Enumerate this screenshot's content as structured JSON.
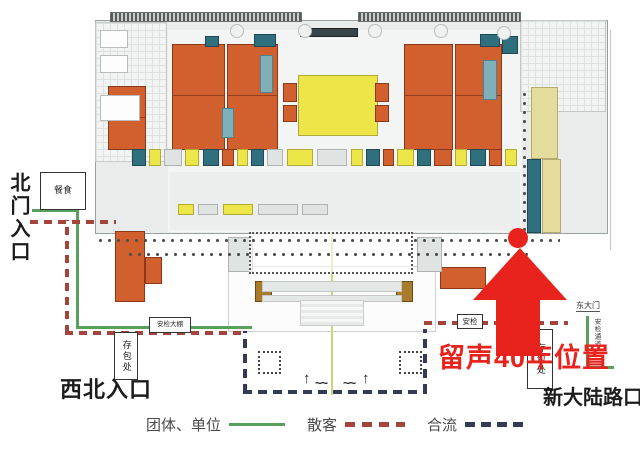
{
  "labels": {
    "north_entrance": "北门入口",
    "northwest_entrance": "西北入口",
    "xindalu_corner": "新大陆路口",
    "highlight_position": "留声40年位置",
    "east_gate": "东大门",
    "security_channel": "安检通道",
    "up_arrow": "↑",
    "wave": "~~"
  },
  "boxes": {
    "food": "餐食",
    "security_tent": "安检大棚",
    "bag_storage_left": "存包处",
    "security": "安检",
    "bag_storage_right": "存包处"
  },
  "legend": {
    "group_label": "团体、单位",
    "individual_label": "散客",
    "merged_label": "合流"
  },
  "colors": {
    "route_group_green": "#58a05c",
    "route_individual_red": "#a3453c",
    "route_merged_navy": "#343a56",
    "marker_red": "#e8221c",
    "hall_orange": "#d2602f",
    "hall_yellow": "#ece649",
    "room_pale_yellow": "#e3dc9d",
    "room_teal": "#2f6f7e",
    "room_teal_light": "#7fb0ba",
    "ornament_gold": "#a87b2d",
    "plan_gray": "#e9eceb"
  }
}
